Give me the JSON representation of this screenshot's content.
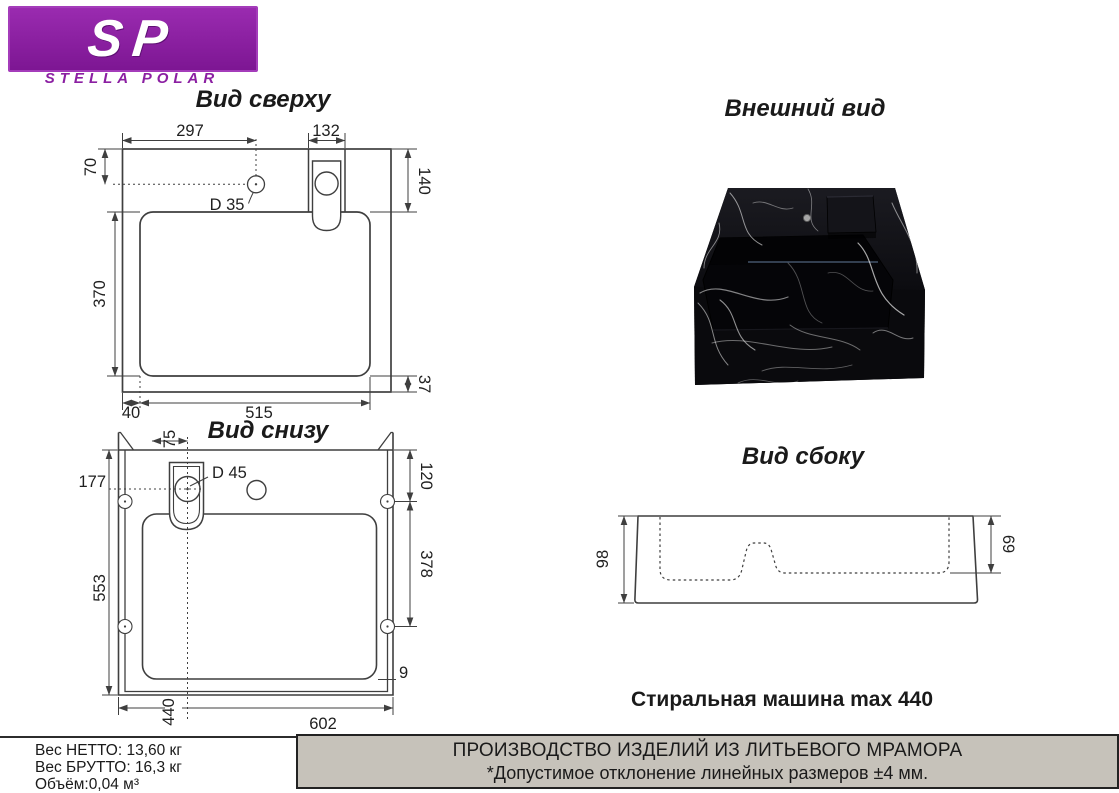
{
  "logo": {
    "initials": "SP",
    "brand": "STELLA POLAR"
  },
  "titles": {
    "top_view": "Вид сверху",
    "bottom_view": "Вид снизу",
    "external_view": "Внешний вид",
    "side_view": "Вид сбоку"
  },
  "caption": "Стиральная машина max 440",
  "top_view": {
    "dims": {
      "d297": "297",
      "d132": "132",
      "d70": "70",
      "d140": "140",
      "d35": "D 35",
      "d370": "370",
      "d37": "37",
      "d40": "40",
      "d515": "515"
    }
  },
  "bottom_view": {
    "dims": {
      "d75": "75",
      "d120": "120",
      "d177": "177",
      "d45": "D 45",
      "d378": "378",
      "d553": "553",
      "d9": "9",
      "d440": "440",
      "d602": "602"
    }
  },
  "side_view": {
    "dims": {
      "d98": "98",
      "d69": "69"
    }
  },
  "footer": {
    "net_weight": "Вес НЕТТО: 13,60 кг",
    "gross_weight": "Вес БРУТТО: 16,3 кг",
    "volume": "Объём:0,04 м³",
    "production": "ПРОИЗВОДСТВО ИЗДЕЛИЙ ИЗ ЛИТЬЕВОГО МРАМОРА",
    "tolerance": "*Допустимое отклонение линейных размеров ±4 мм."
  },
  "colors": {
    "brand_purple": "#8b1fa2",
    "panel_gray": "#c6c2ba",
    "line_gray": "#3f3f3f"
  }
}
